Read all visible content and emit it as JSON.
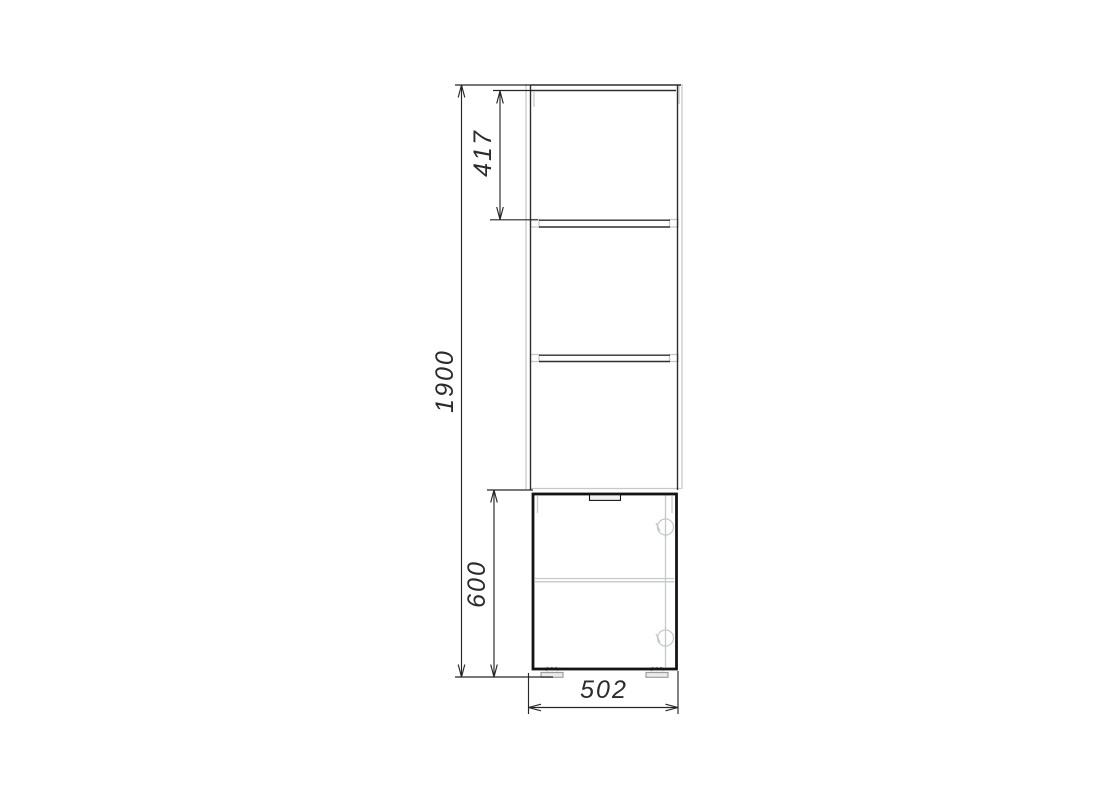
{
  "drawing": {
    "title": "cabinet-front-elevation-drawing",
    "labels": {
      "overall_height": "1900",
      "upper_section_height": "417",
      "lower_cabinet_height": "600",
      "width": "502"
    },
    "colors": {
      "line_dark": "#2e2e2e",
      "dim_line": "#262626",
      "text": "#2b2b2b",
      "door_stroke": "#141414",
      "line_light": "#c6c9cc",
      "line_medium": "#9aa0a4",
      "recess_fill": "#f1f1f1",
      "background": "#ffffff"
    }
  }
}
